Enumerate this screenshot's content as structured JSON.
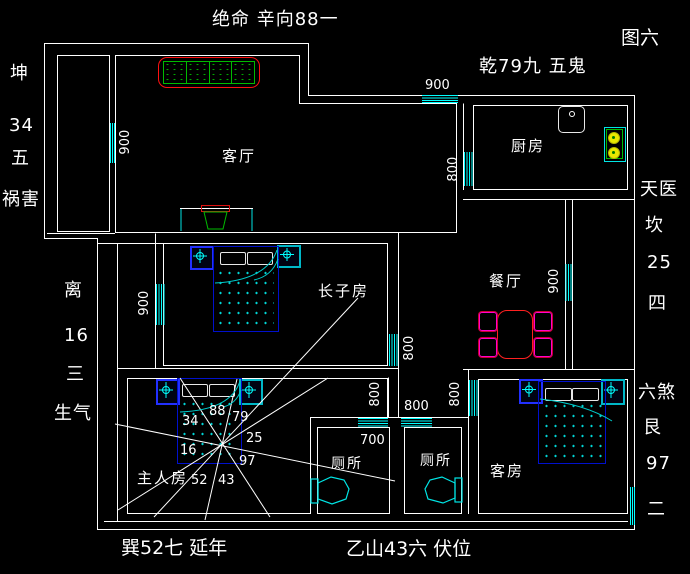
{
  "figure_label": "图六",
  "annotations": {
    "top": "绝命 辛向88一",
    "top_right": "乾79九 五鬼",
    "left_upper": [
      "坤",
      "34",
      "五",
      "祸害"
    ],
    "left_lower": [
      "离",
      "16",
      "三",
      "生气"
    ],
    "right_upper": [
      "天医",
      "坎",
      "25",
      "四"
    ],
    "right_lower": [
      "六煞",
      "艮",
      "97",
      "二"
    ],
    "bottom_left": "巽52七  延年",
    "bottom_right": "乙山43六  伏位"
  },
  "rooms": {
    "living": "客厅",
    "kitchen": "厨房",
    "dining": "餐厅",
    "eldest_son": "长子房",
    "master": "主人房",
    "toilet_left": "厕所",
    "toilet_right": "厕所",
    "guest": "客房"
  },
  "dimensions": {
    "living_window": "900",
    "entry_window": "900",
    "kitchen_window": "800",
    "son_left_window": "900",
    "son_right_window": "800",
    "dining_window": "900",
    "master_window": "800",
    "hall_window": "800",
    "guest_window": "800",
    "toilet_width": "700"
  },
  "bagua_numbers": {
    "nnw": "88",
    "nne": "79",
    "wnw": "34",
    "ene": "25",
    "wsw": "16",
    "ese": "97",
    "ssw": "52",
    "sse": "43"
  },
  "colors": {
    "background": "#000000",
    "wall": "#ffffff",
    "window": "#00ffff",
    "bed_frame": "#0000cc",
    "sofa": "#ff0000",
    "cushion": "#00bb00",
    "table": "#ff2020",
    "chair": "#ff00cc",
    "burner": "#ffff00"
  }
}
